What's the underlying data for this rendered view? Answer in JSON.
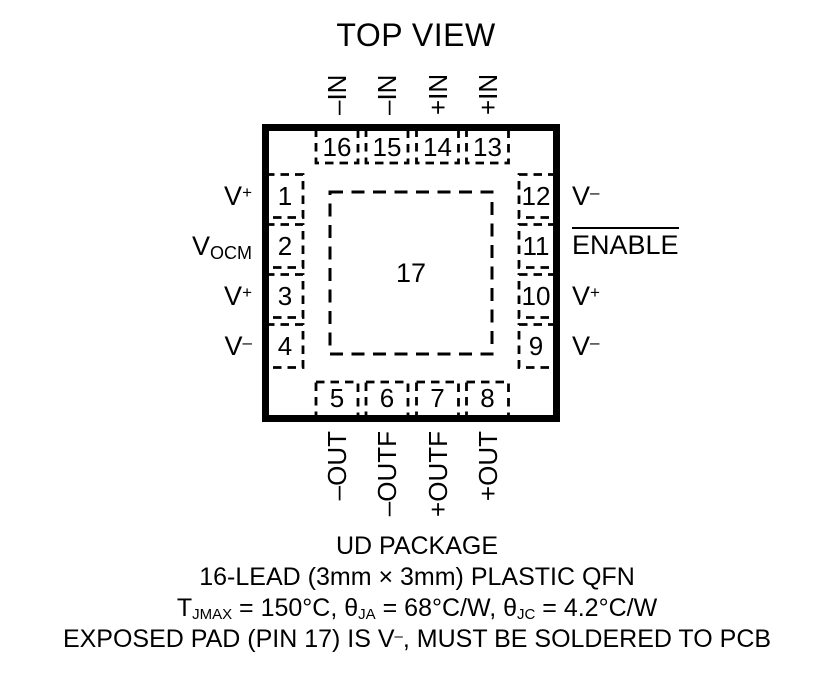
{
  "title": "TOP VIEW",
  "package": {
    "center_pad_number": "17",
    "name": "UD PACKAGE"
  },
  "pins": {
    "top": [
      {
        "num": "16",
        "label": "–IN"
      },
      {
        "num": "15",
        "label": "–IN"
      },
      {
        "num": "14",
        "label": "+IN"
      },
      {
        "num": "13",
        "label": "+IN"
      }
    ],
    "bottom": [
      {
        "num": "5",
        "label": "–OUT"
      },
      {
        "num": "6",
        "label": "–OUTF"
      },
      {
        "num": "7",
        "label": "+OUTF"
      },
      {
        "num": "8",
        "label": "+OUT"
      }
    ],
    "left": [
      {
        "num": "1",
        "base": "V",
        "sup": "+"
      },
      {
        "num": "2",
        "base": "V",
        "sub": "OCM"
      },
      {
        "num": "3",
        "base": "V",
        "sup": "+"
      },
      {
        "num": "4",
        "base": "V",
        "sup": "–"
      }
    ],
    "right": [
      {
        "num": "12",
        "base": "V",
        "sup": "–"
      },
      {
        "num": "11",
        "base": "ENABLE"
      },
      {
        "num": "10",
        "base": "V",
        "sup": "+"
      },
      {
        "num": "9",
        "base": "V",
        "sup": "–"
      }
    ]
  },
  "footer": {
    "line1": "UD PACKAGE",
    "line2": "16-LEAD (3mm × 3mm) PLASTIC QFN",
    "thermal": {
      "p1": "T",
      "s1": "JMAX",
      "p2": " = 150°C, ",
      "p3": "θ",
      "s2": "JA",
      "p4": " = 68°C/W, ",
      "p5": "θ",
      "s3": "JC",
      "p6": " = 4.2°C/W"
    },
    "exposed": {
      "p1": "EXPOSED PAD (PIN 17) IS V",
      "sup": "–",
      "p2": ", MUST BE SOLDERED TO PCB"
    }
  },
  "colors": {
    "ink": "#000000",
    "background": "#ffffff"
  }
}
